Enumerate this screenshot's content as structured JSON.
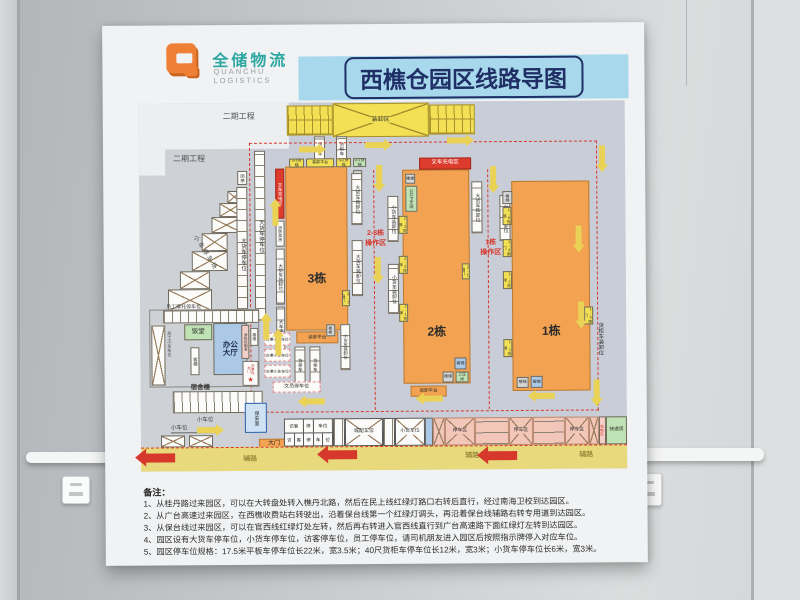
{
  "logo": {
    "cn": "全储物流",
    "en_line1": "QUANCHU",
    "en_line2": "LOGISTICS"
  },
  "title": "西樵仓园区线路导图",
  "phase2": {
    "a": "二期工程",
    "b": "二期工程"
  },
  "top_zone": {
    "label": "装卸区",
    "container_left": "货柜车",
    "container_right": "货柜车"
  },
  "west": {
    "booth": "岗亭",
    "truck_strip1": "大货车停车位",
    "truck_strip2": "大货车停车位",
    "car_lot": "小车停车场"
  },
  "b3": {
    "name": "3栋",
    "charge": "叉车充电区",
    "pump_room": "消防泵房",
    "left_load": "大货车装卸位",
    "left_park": "大车停车位",
    "lift_33": "3-3货梯",
    "platform_top": "装卸平台",
    "lift_32": "3-2货梯",
    "lift_31": "3-1货梯",
    "stair_top": "楼梯",
    "door_31": "3-1扇门",
    "platform_bottom": "装卸平台",
    "stair_bottom": "楼梯",
    "small_load": "小货车装卸位"
  },
  "c23": {
    "big_load_1": "大货车装卸位",
    "big_load_2": "大货车装卸位",
    "small_load_1": "小货车装卸位",
    "small_load_2": "小货车装卸位",
    "op_line1": "2-3栋",
    "op_line2": "操作区"
  },
  "b2": {
    "name": "2栋",
    "charge": "叉车充电区",
    "stair_top": "楼梯",
    "wc_top": "公共卫生间",
    "lift_23": "2-3货梯",
    "lift_22": "2-2货梯",
    "lift_21": "2-1货梯",
    "door_21": "2-1扇门",
    "lift_pass": "客梯",
    "stair_bottom": "楼梯",
    "wc_bottom": "卫生间",
    "platform_bottom": "装卸平台"
  },
  "c1": {
    "big_load": "大货车装卸位",
    "small_load": "小货车装卸位",
    "op_line1": "1栋",
    "op_line2": "操作区"
  },
  "b1": {
    "name": "1栋",
    "stair_top": "楼梯",
    "lift_16": "1-6货梯",
    "door_14": "1-4扇门",
    "lift_12": "1-2货梯",
    "lift_11": "1-1货梯",
    "door_15": "1-5扇门",
    "stair_bottom": "楼梯",
    "lift_pass": "客梯",
    "right_load": "货柜车装卸位"
  },
  "yard": {
    "container_1": "货柜车",
    "container_2": "货柜车",
    "office_car_1": "办事小车车位",
    "office_car_2": "办事小车车位",
    "office_car_3": "办事小车车位",
    "clerk_park": "文员停车位"
  },
  "office": {
    "moto": "员工摩托停车位",
    "staff_car": "员工小车车位",
    "canteen": "饭堂",
    "hall_line1": "办公",
    "hall_line2": "大厅",
    "lift": "客梯",
    "fire_room": "消防控制室",
    "stair": "楼梯",
    "gate_label": "办事处大门",
    "star": "★",
    "dorm": "宿舍楼",
    "car_row": "小车位",
    "car_row2": "小车位"
  },
  "gate": {
    "security": "保安室",
    "gate": "大门",
    "toll": "收费处"
  },
  "south": {
    "visitor_r1": [
      "访客",
      "停",
      "车位"
    ],
    "visitor_r2": [
      "访",
      "客",
      "停",
      "车",
      "位"
    ],
    "city_dist": "城配车位",
    "small_truck": "小货车位",
    "park_1": "停车区",
    "park_2": "停车区",
    "park_3": "停车区",
    "charge": "充电区",
    "express": "快递房",
    "road_1": "辅路",
    "road_2": "辅路",
    "road_3": "辅路"
  },
  "notes": {
    "header": "备注：",
    "lines": [
      "1、从桂丹路过来园区，可以在大转盘处转入樵丹北路，然后在民上线红绿灯路口右转后直行，经过南海卫校到达园区。",
      "2、从广台高速过来园区，在西樵收费站右转驶出，沿着保台线第一个红绿灯调头，再沿着保台线辅路右转专用道到达园区。",
      "3、从保台线过来园区，可以在官西线红绿灯处左转，然后再右转进入官西线直行到广台高速路下面红绿灯左转到达园区。",
      "4、园区设有大货车停车位，小货车停车位，访客停车位，员工停车位，请司机朋友进入园区后按照指示牌停入对应车位。",
      "5、园区停车位规格：17.5米平板车停车位长22米，宽3.5米；40尺货柜车停车位长12米，宽3米；小货车停车位长6米，宽3米。"
    ]
  },
  "colors": {
    "accent_red": "#d6382c",
    "road_yellow": "#e8d97c",
    "building_orange": "#f2a250",
    "title_blue_bg": "#a7d8ec",
    "title_navy": "#203066",
    "logo_teal": "#2fa8a2",
    "logo_orange": "#ef7f35"
  }
}
